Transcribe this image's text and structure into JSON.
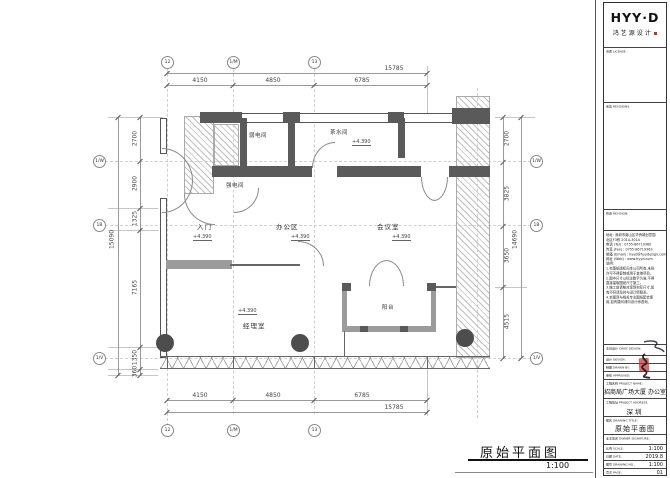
{
  "colors": {
    "wall_dark": "#5a5a5a",
    "wall_gray": "#9b9b9b",
    "dim_line": "#9a9a9a",
    "accent_red": "#b03a2e"
  },
  "plan": {
    "caption_title": "原始平面图",
    "caption_scale": "1:100",
    "elevation": "+4.390",
    "rooms": {
      "ruodian": "弱电间",
      "chashui": "茶水间",
      "qiangdian": "强电间",
      "rumen": "入门",
      "bangong": "办公区",
      "huiyi": "会议室",
      "jingli": "经理室",
      "yangtai": "阳台"
    },
    "dims": {
      "top_total": "15785",
      "top_segments": [
        "4150",
        "4850",
        "6785"
      ],
      "bottom_total": "15785",
      "bottom_segments": [
        "4150",
        "4850",
        "6785"
      ],
      "left_total": "15090",
      "left_segments": [
        "2700",
        "2900",
        "1325",
        "7165",
        "1350",
        "360"
      ],
      "right_total": "14690",
      "right_segments": [
        "2700",
        "3825",
        "3650",
        "4515"
      ]
    },
    "grid": {
      "top": [
        "12",
        "1/M",
        "13"
      ],
      "bottom": [
        "12",
        "1/M",
        "13"
      ],
      "left": [
        "1/W",
        "1B",
        "1/V"
      ],
      "right": [
        "1/W",
        "1B",
        "1/V"
      ]
    }
  },
  "title_block": {
    "brand": "HYY·D",
    "brand_sub": "鸿艺源设计",
    "license_label": "资质 LICENSE:",
    "revisions_label": "会签 REVISIONS:",
    "revision2_label": "修改 REVISION:",
    "contact": {
      "address1": "地址: 深圳市南山区华侨城创意园",
      "address2": "北区F3栋 201A-301A",
      "tel": "电话 (Tel) : 0755-86719360",
      "fax": "传真 (Fax) : 0755-86719363",
      "email": "邮箱 (Email) : hyyd@hyydesign.com",
      "web": "网址 (Web) : www.hyyd.com"
    },
    "notes_label": "说明:",
    "notes": [
      "1.本图纸版权归本公司所有,未经",
      "许可不得复制或用于其他项目。",
      "2.图中尺寸以标注数字为准,不得",
      "直接量取图纸尺寸施工。",
      "3.施工前请核对现场实际尺寸,如",
      "有不符请及时与设计师联系。",
      "4.本图须与相关专业图纸配合使",
      "用,如有疑问请向设计师咨询。"
    ],
    "chief_label": "主创设计 CHIEF DESIGN:",
    "design_label": "设计 DESIGN:",
    "drawn_label": "制图 DRAWN BY:",
    "approved_label": "审核 APPROVED:",
    "project_name_label": "工程名称 PROJECT NAME:",
    "project_name": "招商局广场大厦  办公室",
    "project_addr_label": "工程地址 PROJECT ADDRESS:",
    "project_addr": "深圳",
    "drawing_title_label": "图名 DRAWING TITLE:",
    "drawing_title": "原始平面图",
    "owner_label": "业主签名 OWNER SIGNATURE:",
    "scale_label": "比例 SCALE:",
    "scale": "1:100",
    "date_label": "日期 DATE:",
    "date": "2019.8",
    "no_label": "图号 DRAWING NO.:",
    "no": "1:100",
    "page_label": "页次 PAGE:",
    "page": "01"
  }
}
